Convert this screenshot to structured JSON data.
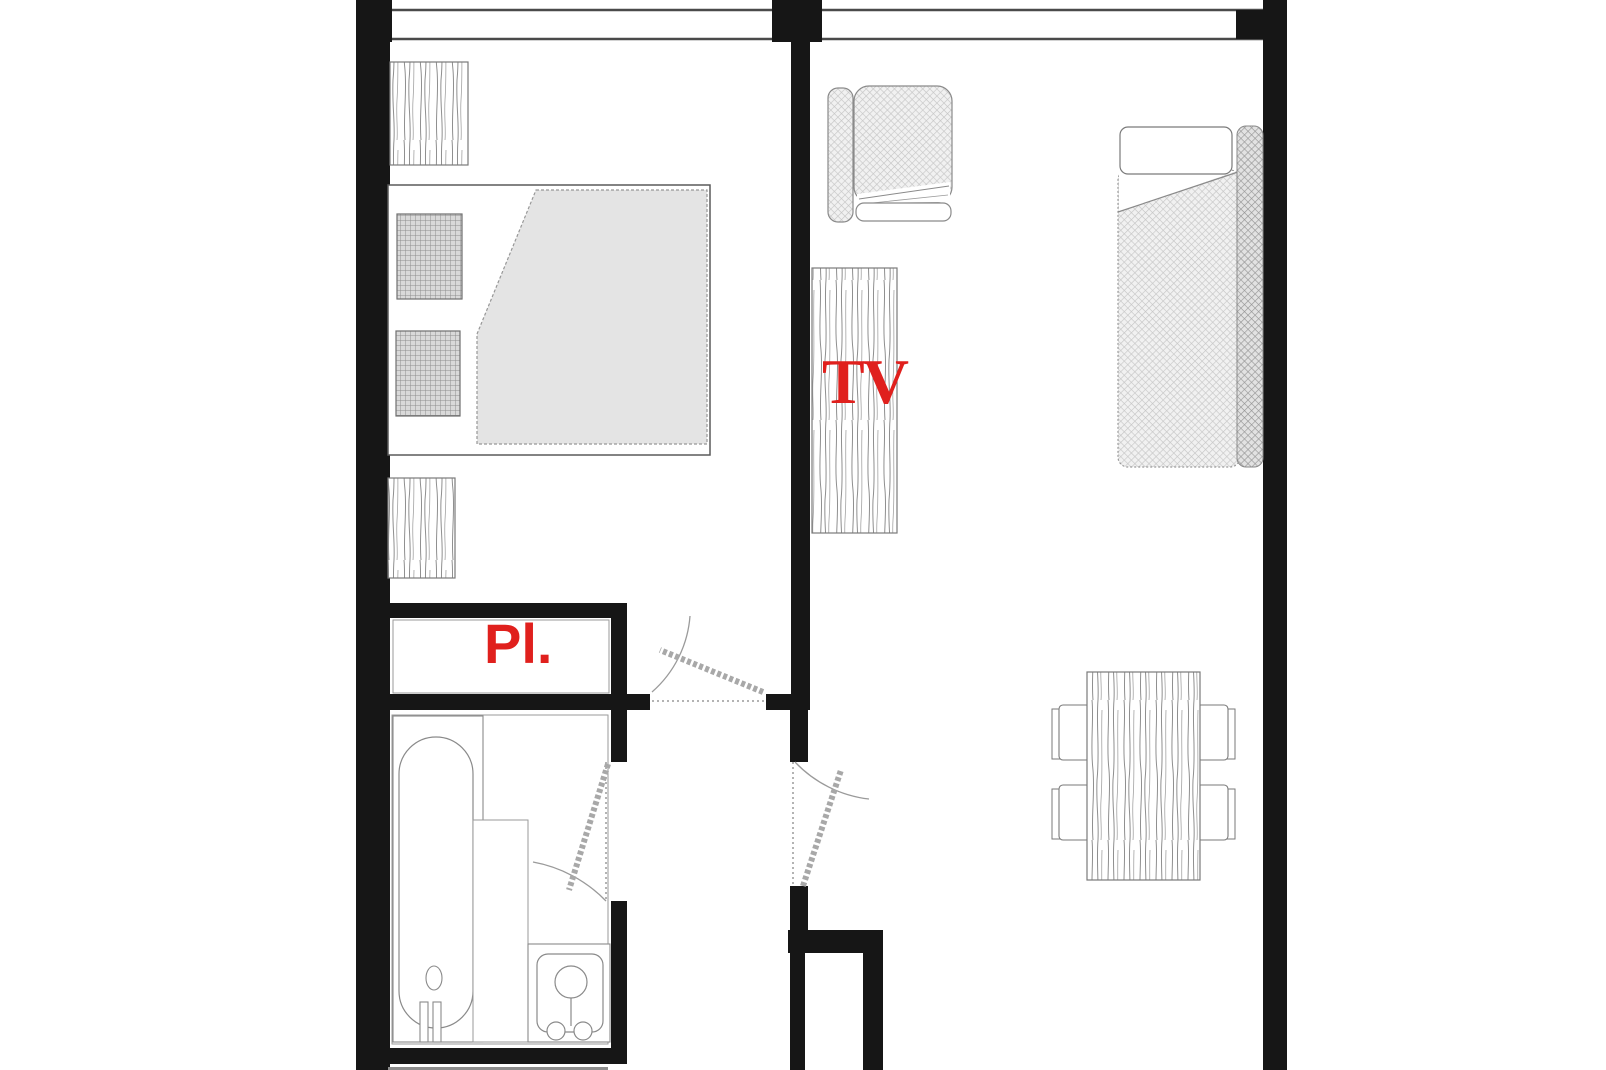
{
  "plan": {
    "title": "apartment-floor-plan",
    "labels": {
      "tv": "TV",
      "closet": "Pl."
    },
    "colors": {
      "wall": "#161616",
      "label_red": "#e0201d",
      "duvet_grey": "#e4e4e4",
      "fabric_hatch": "#f1f1f1",
      "outline_grey": "#7a7a7a",
      "outside_strip_grey": "#8c8c8c"
    }
  }
}
